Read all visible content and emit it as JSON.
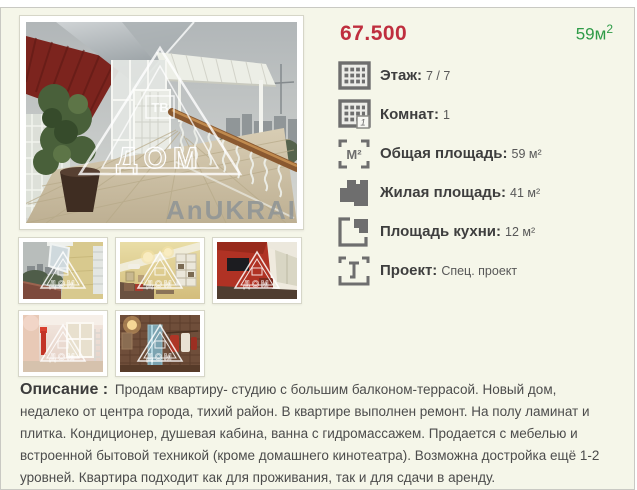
{
  "listing": {
    "price": "67.500",
    "area": {
      "value": "59м",
      "sup": "2"
    },
    "details": [
      {
        "icon": "floors-icon",
        "label": "Этаж:",
        "value": "7 / 7"
      },
      {
        "icon": "rooms-icon",
        "label": "Комнат:",
        "value": "1"
      },
      {
        "icon": "total-area-icon",
        "label": "Общая площадь:",
        "value": "59 м²"
      },
      {
        "icon": "living-area-icon",
        "label": "Жилая площадь:",
        "value": "41 м²"
      },
      {
        "icon": "kitchen-area-icon",
        "label": "Площадь кухни:",
        "value": "12 м²"
      },
      {
        "icon": "project-icon",
        "label": "Проект:",
        "value": "Спец. проект"
      }
    ],
    "icon_glyphs": {
      "m2": "М²",
      "rooms_badge": "1"
    },
    "description": {
      "label": "Описание :",
      "text": "Продам квартиру- студию с большим балконом-террасой. Новый дом, недалеко от центра города, тихий район. В квартире выполнен ремонт. На полу ламинат и плитка. Кондиционер, душевая кабина, ванна с гидромассажем. Продается с мебелью и встроенной бытовой техникой (кроме домашнего кинотеатра). Возможна достройка ещё 1-2 уровней. Квартира подходит как для проживания, так и для сдачи в аренду."
    },
    "gallery": {
      "main_watermark": {
        "badge": "ТВ",
        "word": "ДОМ"
      },
      "photo_overlay_text": "AnUKRAIN",
      "thumbnails": [
        "balcony-view",
        "living-room-yellow",
        "red-wall-room",
        "pink-room",
        "bathroom-tiles"
      ]
    },
    "colors": {
      "page_bg": "#f5f6e9",
      "price": "#bf2e3e",
      "area": "#2e9b47",
      "label": "#3e3e3e",
      "value": "#585858",
      "icon": "#6e6e6e"
    }
  }
}
